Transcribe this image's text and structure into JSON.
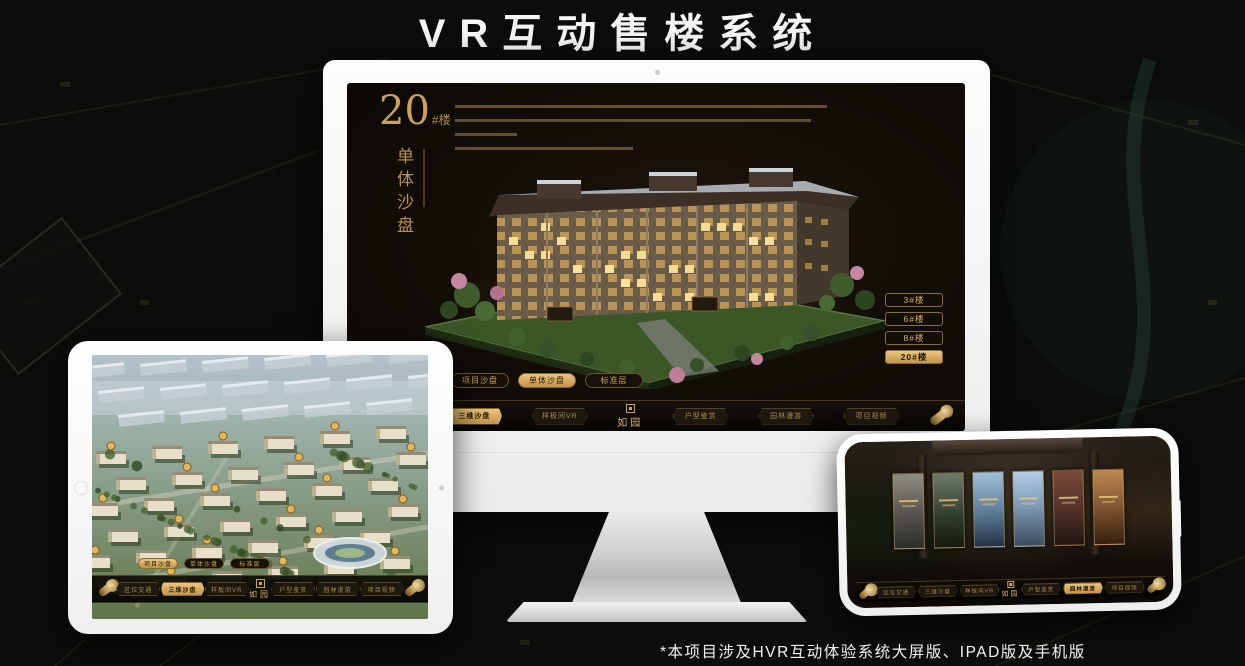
{
  "page": {
    "title": "VR互动售楼系统",
    "footnote": "*本项目涉及HVR互动体验系统大屏版、IPAD版及手机版"
  },
  "nav": {
    "logo": "如园",
    "items": [
      "区位交通",
      "三维沙盘",
      "样板间VR",
      "户型鉴赏",
      "园林漫游",
      "项目视频"
    ]
  },
  "tabs": {
    "items": [
      "项目沙盘",
      "单体沙盘",
      "标准层"
    ]
  },
  "monitor": {
    "heading": {
      "number": "20",
      "suffix": "#楼",
      "vertical_label": "单体沙盘"
    },
    "floor_buttons": [
      {
        "label": "3#楼"
      },
      {
        "label": "6#楼"
      },
      {
        "label": "8#楼"
      },
      {
        "label": "20#楼"
      }
    ],
    "active_floor": "20#楼",
    "active_tab": "单体沙盘",
    "active_nav": "三维沙盘"
  },
  "tablet": {
    "active_tab": "项目沙盘",
    "active_nav": "三维沙盘"
  },
  "phone": {
    "active_nav": "园林漫游",
    "gallery_panels": 6
  },
  "colors": {
    "gold": "#c9a25c",
    "gold_active": "#e2bb72",
    "screen_bg": "#151008",
    "title_white": "#f7f7f7"
  }
}
